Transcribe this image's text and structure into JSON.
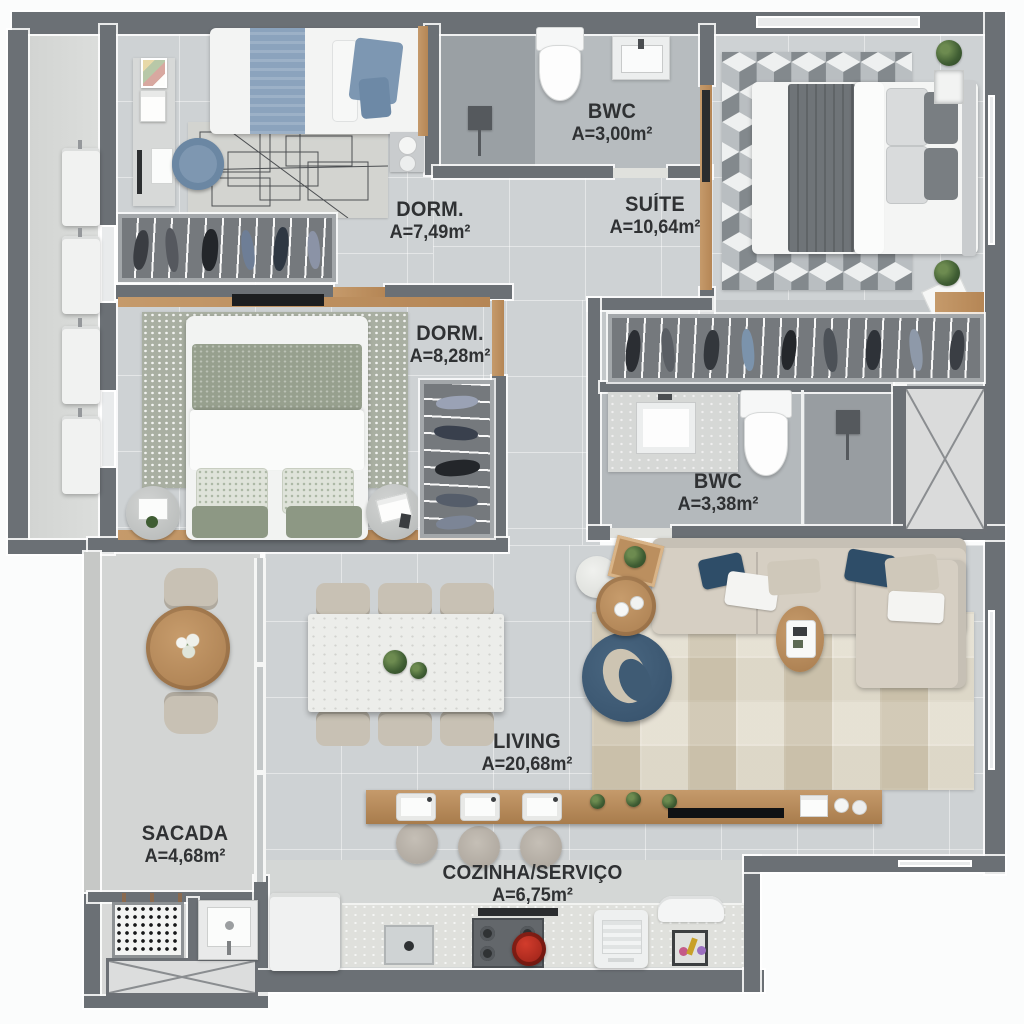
{
  "plan": {
    "type": "apartment-floor-plan",
    "language": "pt-BR",
    "rooms": [
      {
        "id": "dorm1",
        "name": "DORM.",
        "area": "A=7,49m²"
      },
      {
        "id": "bwc1",
        "name": "BWC",
        "area": "A=3,00m²"
      },
      {
        "id": "suite",
        "name": "SUÍTE",
        "area": "A=10,64m²"
      },
      {
        "id": "dorm2",
        "name": "DORM.",
        "area": "A=8,28m²"
      },
      {
        "id": "bwc2",
        "name": "BWC",
        "area": "A=3,38m²"
      },
      {
        "id": "living",
        "name": "LIVING",
        "area": "A=20,68m²"
      },
      {
        "id": "sacada",
        "name": "SACADA",
        "area": "A=4,68m²"
      },
      {
        "id": "cozinha",
        "name": "COZINHA/SERVIÇO",
        "area": "A=6,75m²"
      }
    ],
    "furniture": {
      "dorm1": [
        "single-bed",
        "blue-bedding",
        "desk",
        "desk-chair",
        "geometric-rug",
        "wardrobe-rail",
        "nightstand",
        "wall-posters"
      ],
      "bwc1": [
        "toilet",
        "sink-vanity",
        "shower"
      ],
      "suite": [
        "double-bed",
        "cube-pattern-rug",
        "wardrobe-rail",
        "plants",
        "art-frame",
        "bench-mat"
      ],
      "dorm2": [
        "double-bed",
        "sage-bedding",
        "dotted-rug",
        "tv",
        "round-side-tables",
        "wardrobe-rail"
      ],
      "bwc2": [
        "sink-vanity",
        "toilet",
        "shower"
      ],
      "living": [
        "marble-dining-table",
        "dining-chairs-6",
        "sectional-sofa",
        "swivel-armchair",
        "coffee-tables",
        "oval-side-table",
        "tv-console",
        "bar-counter",
        "bar-stools-3",
        "patchwork-rug"
      ],
      "sacada": [
        "round-wood-table",
        "outdoor-chairs-2",
        "flower-vase",
        "glass-partition"
      ],
      "cozinha": [
        "refrigerator",
        "kitchen-sink",
        "cooktop",
        "red-pot",
        "washing-machine",
        "laundry-appliance",
        "countertop",
        "service-tub",
        "floor-drain"
      ],
      "common": [
        "ac-units-4",
        "technical-shaft",
        "service-shaft"
      ]
    },
    "colors": {
      "wall": "#6b7075",
      "floor": "#ced2d4",
      "floor_bathroom": "#b6bbbe",
      "floor_shower": "#9aa0a4",
      "wood": "#bd9265",
      "marble": "#ebece9",
      "sofa_beige": "#d6cfc3",
      "accent_navy": "#3f5b74",
      "accent_blue": "#7e98b4",
      "accent_sage": "#97a08e",
      "stove_red": "#b5271c",
      "plant_green": "#3f5d33",
      "label_text": "#2f3133",
      "background": "#fbfcfc"
    }
  }
}
